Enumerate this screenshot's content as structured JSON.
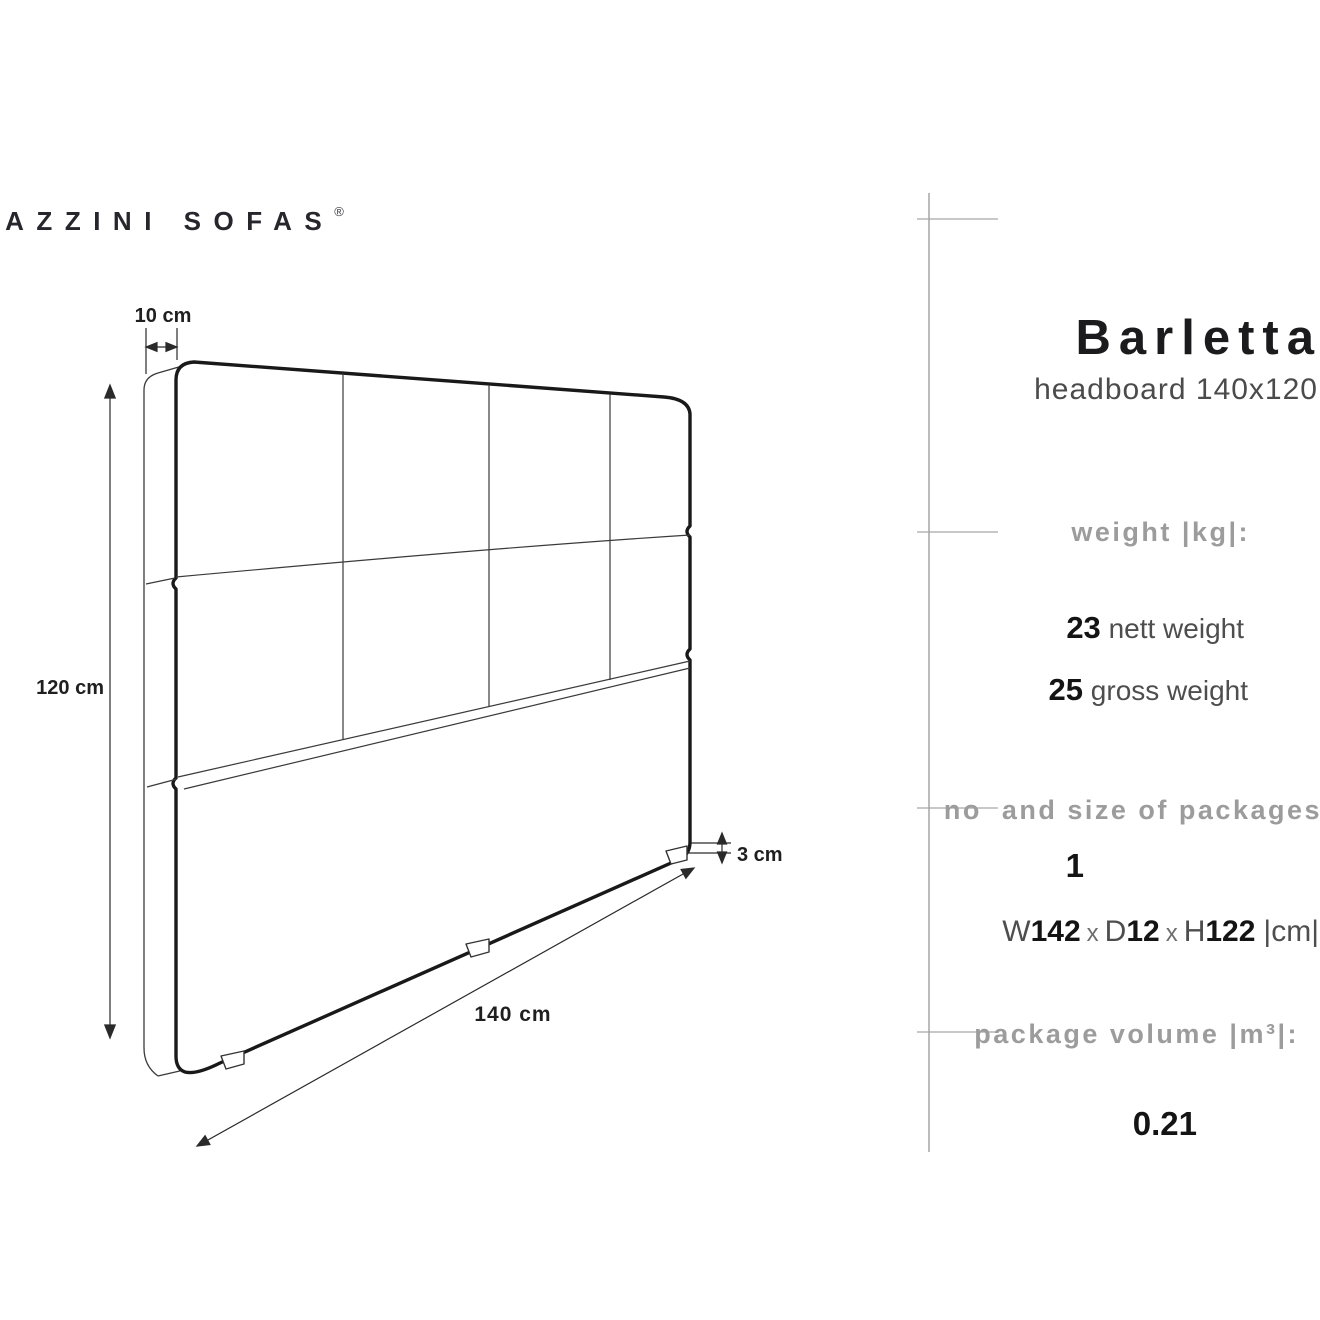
{
  "logo": {
    "brand": "MAZZINI SOFAS",
    "reg": "®"
  },
  "product": {
    "title": "Barletta",
    "subtitle": "headboard 140x120"
  },
  "sections": {
    "weight": {
      "heading": "weight |kg|:",
      "nett_value": "23",
      "nett_label": " nett weight",
      "gross_value": "25",
      "gross_label": " gross weight"
    },
    "packages": {
      "heading": "no  and size of packages",
      "count": "1",
      "dims": {
        "w_label": "W",
        "w": "142",
        "x1": "x",
        "d_label": "D",
        "d": "12",
        "x2": "x",
        "h_label": "H",
        "h": "122",
        "unit": "|cm|"
      }
    },
    "volume": {
      "heading": "package volume |m³|:",
      "value": "0.21"
    }
  },
  "diagram": {
    "dim_depth_top": "10 cm",
    "dim_height_left": "120 cm",
    "dim_foot_right": "3 cm",
    "dim_width_bottom": "140 cm"
  },
  "colors": {
    "ink": "#191919",
    "thin_line": "#3a3a3a",
    "heading_gray": "#9c9c9c",
    "separator_gray": "#a6a6a6",
    "text_dark": "#141414",
    "text_mid": "#4e4e4e"
  }
}
